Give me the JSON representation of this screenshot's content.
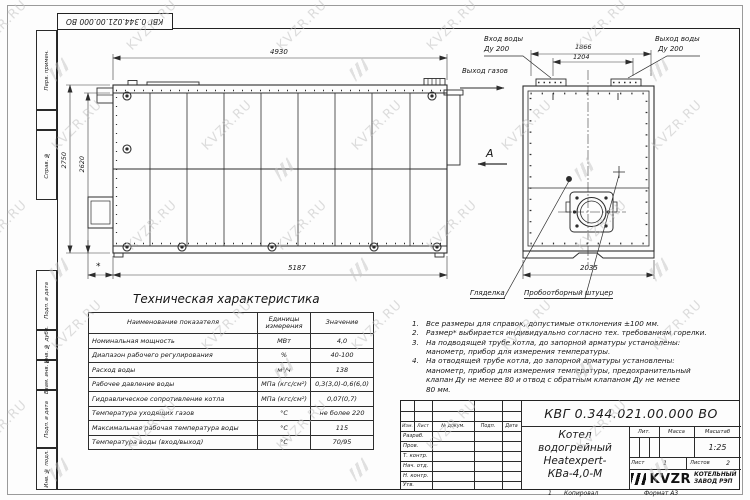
{
  "sheet": {
    "doc_number_top": "КВГ 0.344.021.00.000 ВО",
    "watermark_text": "KVZR.RU"
  },
  "margin_labels": [
    "Перв. примен.",
    "Справ. №",
    "Подп. и дата",
    "Инв. № дубл.",
    "Взам. инв. №",
    "Подп. и дата",
    "Инв. № подл."
  ],
  "side_view": {
    "dim_top": "4930",
    "dim_height_outer": "2750",
    "dim_height_inner": "2620",
    "dim_bottom": "5187",
    "dim_asterisk": "*",
    "gas_outlet_label": "Выход газов",
    "view_arrow_label": "А"
  },
  "rear_view": {
    "dim_flanges_outer": "1866",
    "dim_flanges_inner": "1204",
    "dim_bottom": "2035",
    "water_inlet_line1": "Вход воды",
    "water_inlet_line2": "Ду 200",
    "water_outlet_line1": "Выход воды",
    "water_outlet_line2": "Ду 200",
    "sight_glass_label": "Гляделка",
    "sampling_fitting_label": "Пробоотборный штуцер"
  },
  "spec_table": {
    "title": "Техническая характеристика",
    "headers": [
      "Наименование показателя",
      "Единицы измерения",
      "Значение"
    ],
    "rows": [
      [
        "Номинальная мощность",
        "МВт",
        "4,0"
      ],
      [
        "Диапазон рабочего регулирования",
        "%",
        "40-100"
      ],
      [
        "Расход воды",
        "м³/ч",
        "138"
      ],
      [
        "Рабочее давление воды",
        "МПа (кгс/см²)",
        "0,3(3,0)-0,6(6,0)"
      ],
      [
        "Гидравлическое сопротивление котла",
        "МПа (кгс/см²)",
        "0,07(0,7)"
      ],
      [
        "Температура уходящих газов",
        "°С",
        "не более 220"
      ],
      [
        "Максимальная рабочая температура воды",
        "°С",
        "115"
      ],
      [
        "Температура воды (вход/выход)",
        "°С",
        "70/95"
      ]
    ]
  },
  "notes": {
    "numbers": [
      "1.",
      "2.",
      "3.",
      "4."
    ],
    "items": [
      "Все размеры для справок, допустимые отклонения ±100 мм.",
      "Размер* выбирается индивидуально согласно тех. требованиям горелки.",
      "На подводящей трубе котла, до запорной арматуры установлены:\nманометр, прибор для измерения температуры.",
      "На отводящей трубе котла, до запорной арматуры установлены:\nманометр, прибор для измерения температуры, предохранительный\nклапан Ду не менее 80 и отвод с обратным клапаном Ду не менее\n80 мм."
    ]
  },
  "title_block": {
    "doc_number": "КВГ 0.344.021.00.000 ВО",
    "product_name_line1": "Котел водогрейный",
    "product_name_line2": "Heatexpert-КВа-4,0-М",
    "header_cols": [
      "Изм.",
      "Лист",
      "№ докум.",
      "Подп.",
      "Дата"
    ],
    "row_labels": [
      "Разраб.",
      "Пров.",
      "Т. контр.",
      "Нач. отд.",
      "Н. контр.",
      "Утв."
    ],
    "lit_label": "Лит.",
    "mass_label": "Масса",
    "scale_label": "Масштаб",
    "scale_value": "1:25",
    "sheet_label": "Лист",
    "sheet_value": "1",
    "sheets_label": "Листов",
    "sheets_value": "2",
    "logo_text": "KVZR",
    "company_line1": "КОТЕЛЬНЫЙ",
    "company_line2": "ЗАВОД РЭП"
  },
  "footer": {
    "fold_mark": "1",
    "copied_label": "Копировал",
    "format_label": "Формат А3"
  }
}
